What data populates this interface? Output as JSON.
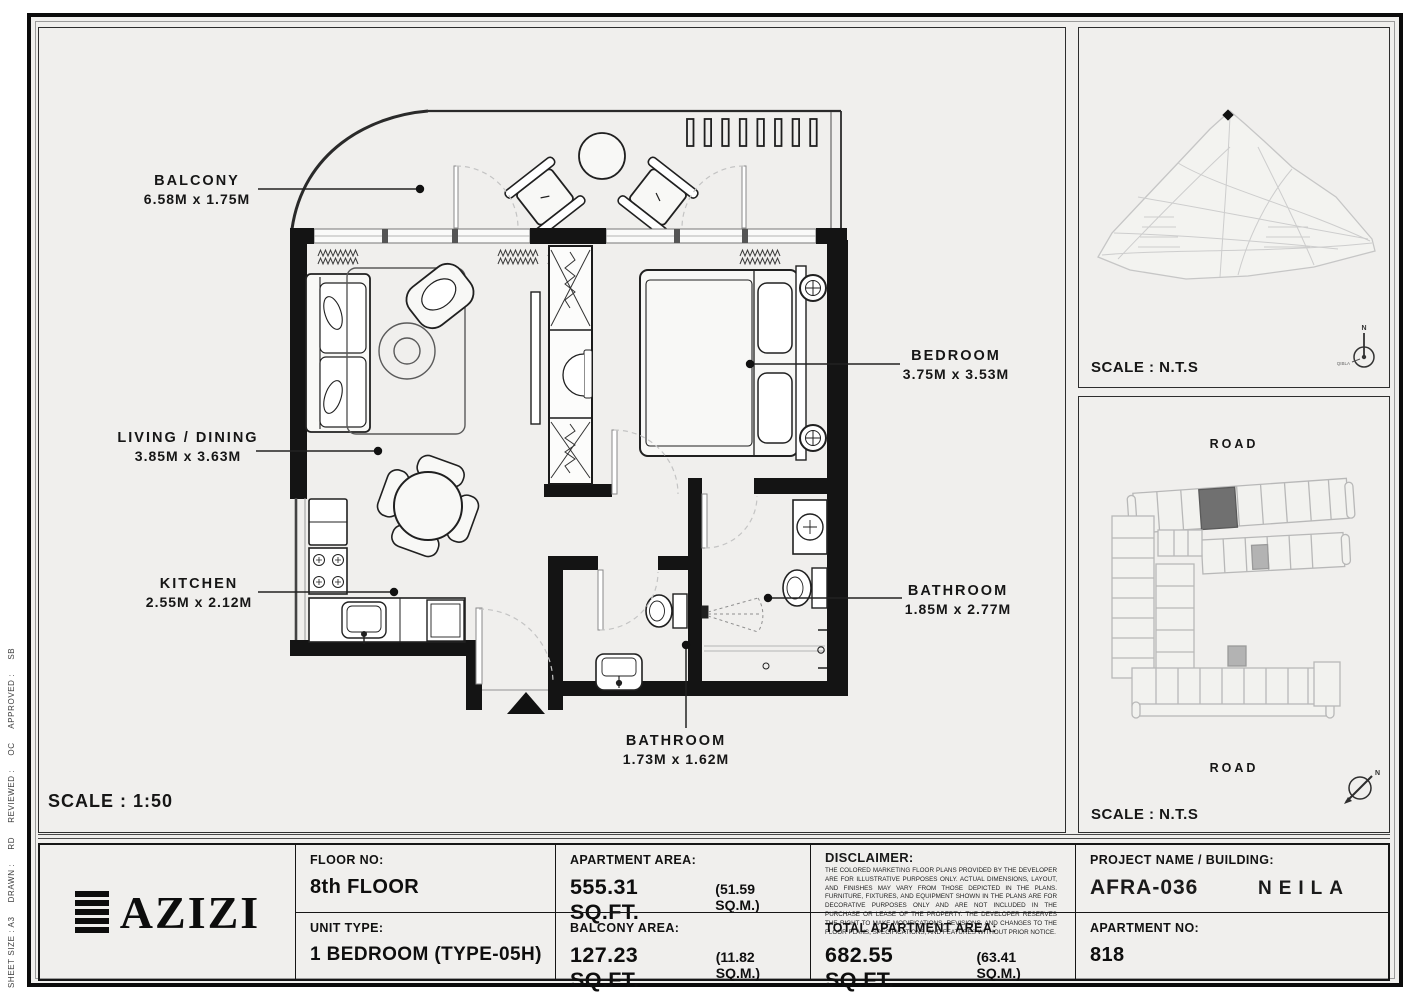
{
  "colors": {
    "page_bg": "#f0efed",
    "ink": "#1a1a1a",
    "wall": "#141414",
    "light_line": "#c4c4c4",
    "map_line": "#c6c6c6",
    "highlight_unit": "#707070"
  },
  "floor_plan": {
    "scale_label": "SCALE : 1:50",
    "labels": {
      "balcony": {
        "name": "BALCONY",
        "dims": "6.58M x 1.75M"
      },
      "living": {
        "name": "LIVING / DINING",
        "dims": "3.85M x 3.63M"
      },
      "kitchen": {
        "name": "KITCHEN",
        "dims": "2.55M x 2.12M"
      },
      "bedroom": {
        "name": "BEDROOM",
        "dims": "3.75M x 3.53M"
      },
      "bathroom_main": {
        "name": "BATHROOM",
        "dims": "1.85M x 2.77M"
      },
      "bathroom_guest": {
        "name": "BATHROOM",
        "dims": "1.73M x 1.62M"
      }
    }
  },
  "site_map": {
    "scale_label": "SCALE : N.T.S",
    "north_label": "N",
    "qibla_label": "QIBLA"
  },
  "key_plan": {
    "scale_label": "SCALE : N.T.S",
    "road_top_label": "ROAD",
    "road_bottom_label": "ROAD",
    "north_label": "N"
  },
  "title_block": {
    "brand": "AZIZI",
    "floor": {
      "label": "FLOOR NO:",
      "value": "8th FLOOR"
    },
    "unit_type": {
      "label": "UNIT TYPE:",
      "value": "1 BEDROOM (TYPE-05H)"
    },
    "apartment_area": {
      "label": "APARTMENT AREA:",
      "value": "555.31 SQ.FT.",
      "metric": "(51.59 SQ.M.)"
    },
    "balcony_area": {
      "label": "BALCONY AREA:",
      "value": "127.23 SQ.FT.",
      "metric": "(11.82 SQ.M.)"
    },
    "total_area": {
      "label": "TOTAL APARTMENT AREA:",
      "value": "682.55 SQ.FT.",
      "metric": "(63.41 SQ.M.)"
    },
    "disclaimer": {
      "label": "DISCLAIMER:",
      "body": "THE COLORED MARKETING FLOOR PLANS PROVIDED BY THE DEVELOPER ARE FOR ILLUSTRATIVE PURPOSES ONLY. ACTUAL DIMENSIONS, LAYOUT, AND FINISHES MAY VARY FROM THOSE DEPICTED IN THE PLANS. FURNITURE, FIXTURES, AND EQUIPMENT SHOWN IN THE PLANS ARE FOR DECORATIVE PURPOSES ONLY AND ARE NOT INCLUDED IN THE PURCHASE OR LEASE OF THE PROPERTY. THE DEVELOPER RESERVES THE RIGHT TO MAKE MODIFICATIONS, REVISIONS, AND CHANGES TO THE FLOOR PLANS, SPECIFICATIONS, AND FEATURES WITHOUT PRIOR NOTICE."
    },
    "project": {
      "label": "PROJECT NAME / BUILDING:",
      "code": "AFRA-036",
      "building": "NEILA"
    },
    "apartment_no": {
      "label": "APARTMENT NO:",
      "value": "818"
    }
  },
  "sheet_meta": {
    "text": "SHEET SIZE : A3     DRAWN :     RD     REVIEWED :     OC     APPROVED :     SB"
  }
}
